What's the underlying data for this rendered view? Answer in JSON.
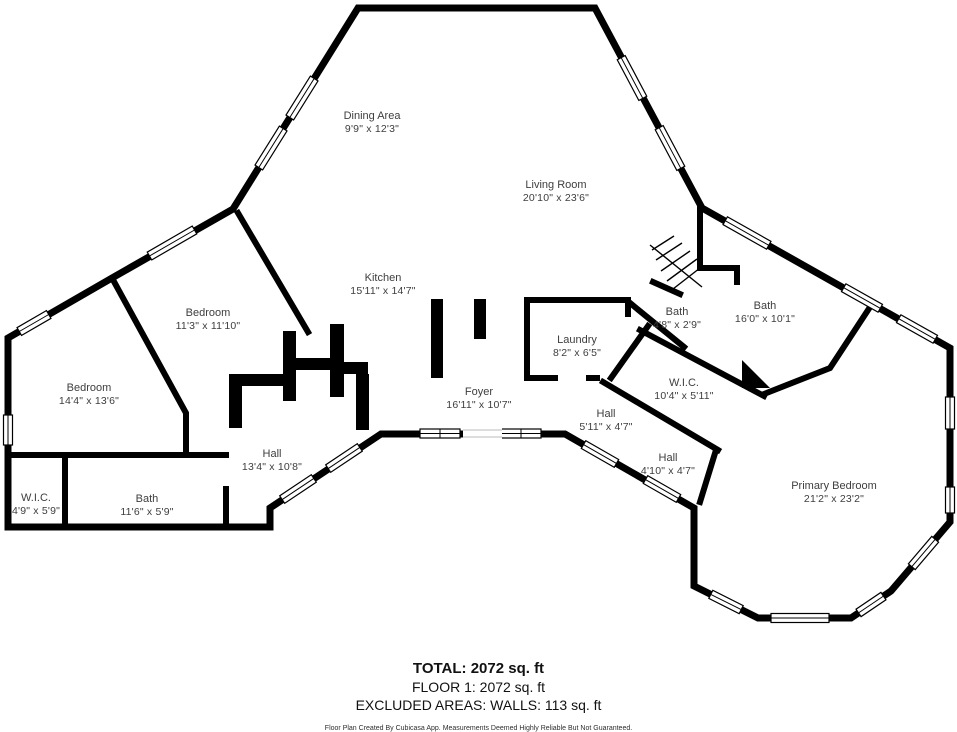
{
  "page": {
    "background_color": "#ffffff",
    "wall_color": "#000000",
    "label_color": "#3e3e3e"
  },
  "rooms": [
    {
      "name": "Dining Area",
      "dims": "9'9\" x 12'3\""
    },
    {
      "name": "Living Room",
      "dims": "20'10\" x 23'6\""
    },
    {
      "name": "Kitchen",
      "dims": "15'11\" x 14'7\""
    },
    {
      "name": "Bedroom",
      "dims": "11'3\" x 11'10\""
    },
    {
      "name": "Bedroom",
      "dims": "14'4\" x 13'6\""
    },
    {
      "name": "W.I.C.",
      "dims": "4'9\" x 5'9\""
    },
    {
      "name": "Bath",
      "dims": "11'6\" x 5'9\""
    },
    {
      "name": "Hall",
      "dims": "13'4\" x 10'8\""
    },
    {
      "name": "Foyer",
      "dims": "16'11\" x 10'7\""
    },
    {
      "name": "Laundry",
      "dims": "8'2\" x 6'5\""
    },
    {
      "name": "Bath",
      "dims": "4'8\" x 2'9\""
    },
    {
      "name": "Bath",
      "dims": "16'0\" x 10'1\""
    },
    {
      "name": "W.I.C.",
      "dims": "10'4\" x 5'11\""
    },
    {
      "name": "Hall",
      "dims": "5'11\" x 4'7\""
    },
    {
      "name": "Hall",
      "dims": "4'10\" x 4'7\""
    },
    {
      "name": "Primary Bedroom",
      "dims": "21'2\" x 23'2\""
    }
  ],
  "summary": {
    "total": "TOTAL: 2072 sq. ft",
    "floor": "FLOOR 1: 2072 sq. ft",
    "excluded": "EXCLUDED AREAS: WALLS: 113 sq. ft"
  },
  "disclaimer": "Floor Plan Created By Cubicasa App. Measurements Deemed Highly Reliable But Not Guaranteed."
}
